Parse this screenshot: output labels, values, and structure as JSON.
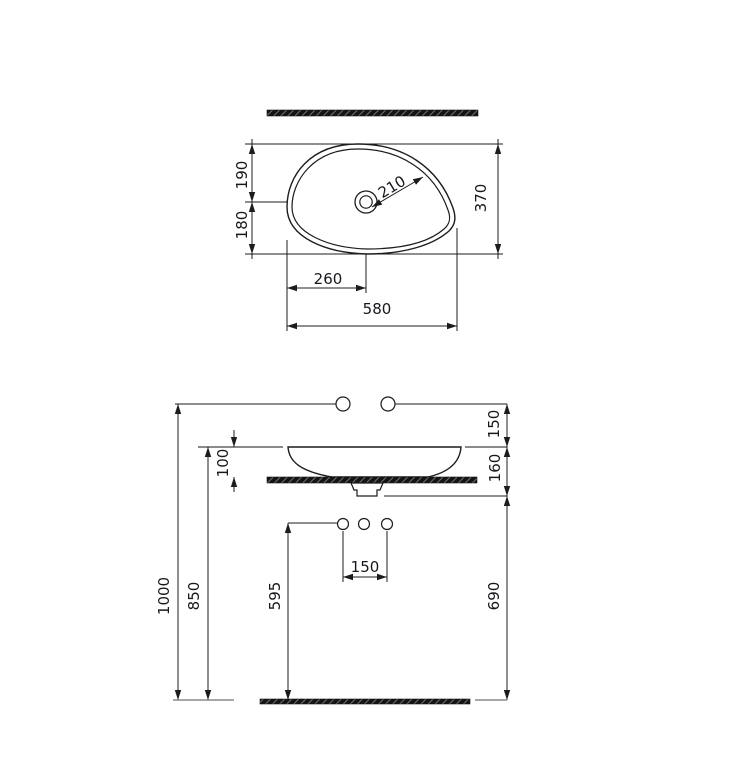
{
  "drawing": {
    "type": "washbasin installation technical drawing",
    "colors": {
      "line": "#1c1c1c",
      "gray_line": "#8a8a8a",
      "hatch_fill": "#141414",
      "text": "#15181d",
      "background": "#ffffff"
    },
    "dimensions_top": {
      "width_mm": "580",
      "depth_mm": "370",
      "front_depth_mm": "190",
      "back_depth_mm": "180",
      "drain_center_x_mm": "260",
      "drain_diag_mm": "210"
    },
    "dimensions_front": {
      "faucet_above_rim_mm": "150",
      "rim_above_counter_mm": "100",
      "rim_to_drain_mm": "160",
      "hole_spacing_mm": "150",
      "faucet_height_mm": "1000",
      "rim_height_mm": "850",
      "waste_outlet_height_mm": "595",
      "drain_bottom_height_mm": "690"
    }
  }
}
